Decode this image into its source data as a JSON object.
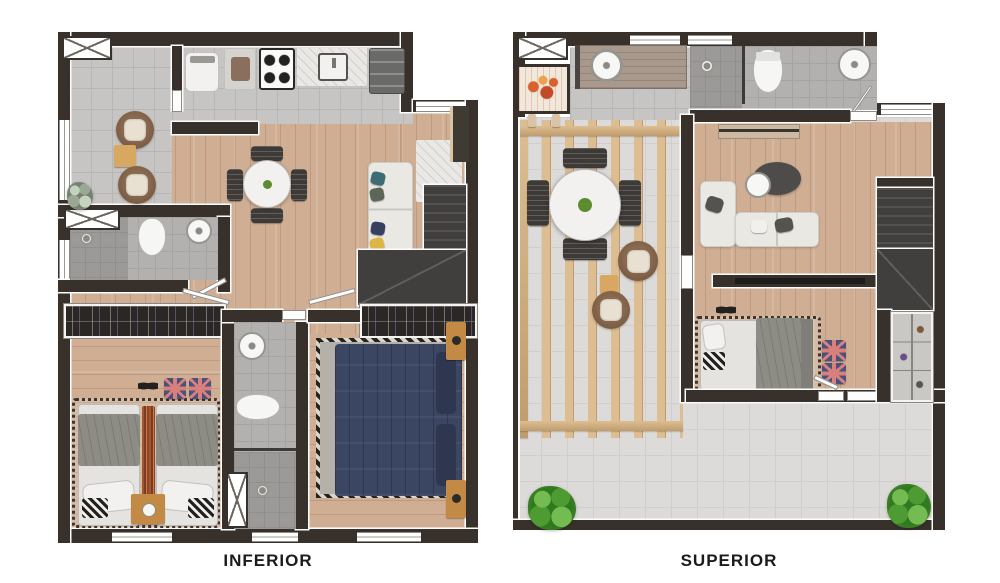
{
  "page": {
    "background_color": "#ffffff",
    "description": "Top-down 3D render of duplex apartment floor plans, lower and upper levels side by side"
  },
  "labels": {
    "inferior": "INFERIOR",
    "superior": "SUPERIOR"
  },
  "colors": {
    "wall": "#38302b",
    "wood": "#cfae94",
    "tile": "#c6c5c3",
    "tile_line": "#b7b6b4",
    "bath": "#b2b1af",
    "bath_line": "#a5a4a2",
    "shower": "#9b9a98",
    "shower_line": "#908f8d",
    "terrace": "#dcdbd9",
    "terrace_line": "#d0cfcd",
    "pergola": "#dcbe92",
    "pergola_dark": "#c09c6c",
    "stairs": "#413f3e",
    "stair_line": "#535150",
    "wardrobe": "#2b2724",
    "white_obj": "#f2f1ef",
    "navy": "#3b4663",
    "gray_blanket": "#8d8c85",
    "chair_brown": "#7b5b42",
    "cushion": "#e8e0d0",
    "tan": "#c28a45",
    "jack_navy": "#49527b",
    "jack_red": "#d97f7c",
    "plant": "#4e9a33",
    "plant_light": "#74bb52",
    "plant_dark": "#2f7a1f",
    "fire": "#d8622f",
    "label": "#1b1b1b",
    "sofa": "#eae8e3",
    "dark_obj": "#454340",
    "marble": "#e9e8e5"
  },
  "plans": {
    "inferior": {
      "features": [
        "elevator-shaft",
        "balcony-lounge",
        "kitchen",
        "laundry-machines",
        "stove",
        "counter-sink",
        "fridge",
        "dining-table",
        "sofa",
        "stairs",
        "bathroom",
        "twin-bedroom",
        "double-bedroom",
        "wardrobes",
        "second-bathroom"
      ]
    },
    "superior": {
      "features": [
        "elevator-shaft",
        "barbecue-grill",
        "gourmet-counter",
        "bathroom",
        "pergola-dining",
        "lounge-chairs",
        "living-sofa",
        "desk-chair",
        "tv-wall",
        "stairs",
        "bedroom",
        "closet",
        "roof-terrace",
        "plants"
      ]
    }
  }
}
